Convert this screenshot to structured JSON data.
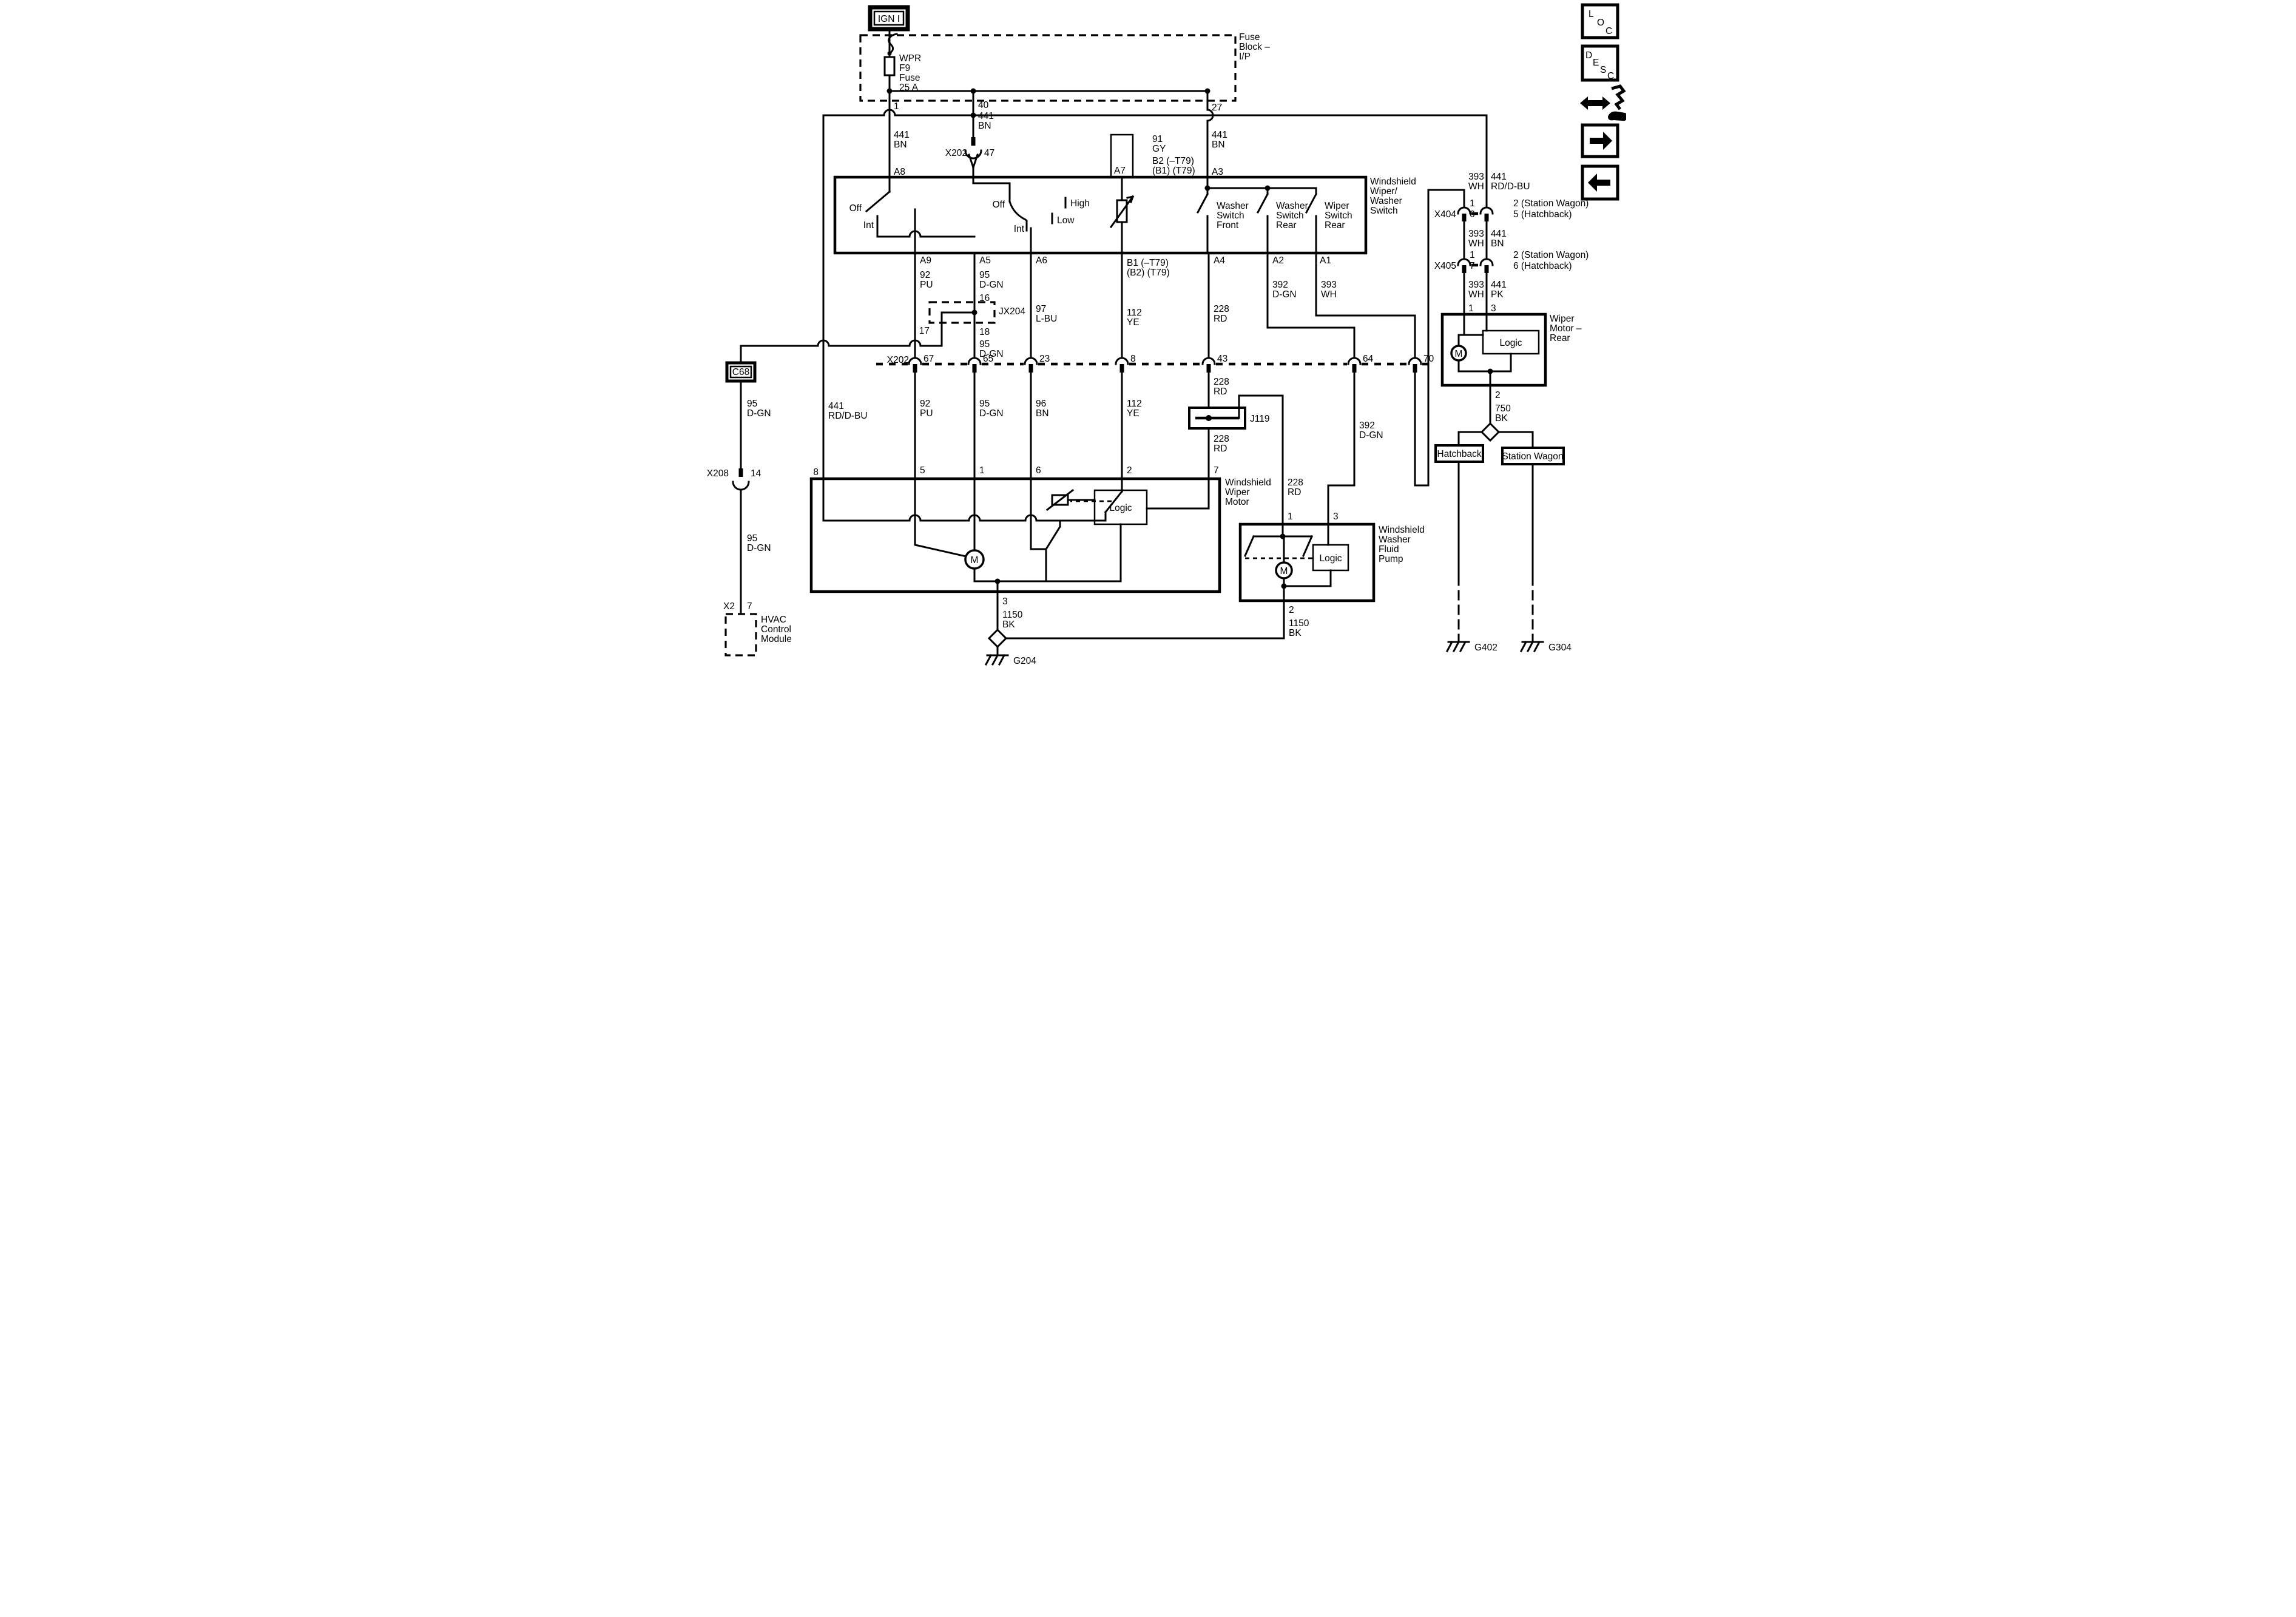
{
  "t": {
    "ign": "IGN I",
    "fuse_block": [
      "Fuse",
      "Block –",
      "I/P"
    ],
    "wpr": "WPR",
    "f9": "F9",
    "fuse_word": "Fuse",
    "fuse_rating": "25 A",
    "n1": "1",
    "n2": "2",
    "n3": "3",
    "n5": "5",
    "n6": "6",
    "n7": "7",
    "n8": "8",
    "n14": "14",
    "n16": "16",
    "n17": "17",
    "n18": "18",
    "n23": "23",
    "n27": "27",
    "n40": "40",
    "n43": "43",
    "n47": "47",
    "n64": "64",
    "n65": "65",
    "n67": "67",
    "n70": "70",
    "x202": "X202",
    "x208": "X208",
    "x404": "X404",
    "x405": "X405",
    "x2": "X2",
    "jx204": "JX204",
    "c68": "C68",
    "j119": "J119",
    "w441bn": [
      "441",
      "BN"
    ],
    "w441rdbu": [
      "441",
      "RD/D-BU"
    ],
    "w441pk": [
      "441",
      "PK"
    ],
    "w91gy": [
      "91",
      "GY"
    ],
    "w92pu": [
      "92",
      "PU"
    ],
    "w95dgn": [
      "95",
      "D-GN"
    ],
    "w97lbu": [
      "97",
      "L-BU"
    ],
    "w96bn": [
      "96",
      "BN"
    ],
    "w112ye": [
      "112",
      "YE"
    ],
    "w228rd": [
      "228",
      "RD"
    ],
    "w392dgn": [
      "392",
      "D-GN"
    ],
    "w393wh": [
      "393",
      "WH"
    ],
    "w750bk": [
      "750",
      "BK"
    ],
    "w1150bk": [
      "1150",
      "BK"
    ],
    "a8": "A8",
    "a9": "A9",
    "a5": "A5",
    "a6": "A6",
    "a7": "A7",
    "a3": "A3",
    "a4": "A4",
    "a2": "A2",
    "a1": "A1",
    "b2_1": "B2 (–T79)",
    "b2_2": "(B1) (T79)",
    "b1_1": "B1 (–T79)",
    "b1_2": "(B2) (T79)",
    "off": "Off",
    "int": "Int",
    "high": "High",
    "low": "Low",
    "sw_front": [
      "Washer",
      "Switch",
      "Front"
    ],
    "sw_rear": [
      "Washer",
      "Switch",
      "Rear"
    ],
    "sw_wiper_rear": [
      "Wiper",
      "Switch",
      "Rear"
    ],
    "switch_title": [
      "Windshield",
      "Wiper/",
      "Washer",
      "Switch"
    ],
    "motor_title": [
      "Windshield",
      "Wiper",
      "Motor"
    ],
    "pump_title": [
      "Windshield",
      "Washer",
      "Fluid",
      "Pump"
    ],
    "rear_motor_title": [
      "Wiper",
      "Motor –",
      "Rear"
    ],
    "hvac": [
      "HVAC",
      "Control",
      "Module"
    ],
    "logic": "Logic",
    "m": "M",
    "hatchback": "Hatchback",
    "wagon": "Station Wagon",
    "g204": "G204",
    "g402": "G402",
    "g304": "G304",
    "sw2": "2 (Station Wagon)",
    "hb5": "5 (Hatchback)",
    "hb6": "6 (Hatchback)"
  },
  "icons": {
    "loc": [
      "L",
      "O",
      "C"
    ],
    "desc": [
      "D",
      "E",
      "S",
      "C"
    ]
  },
  "colors": {
    "line": "#000000",
    "background": "#ffffff"
  }
}
